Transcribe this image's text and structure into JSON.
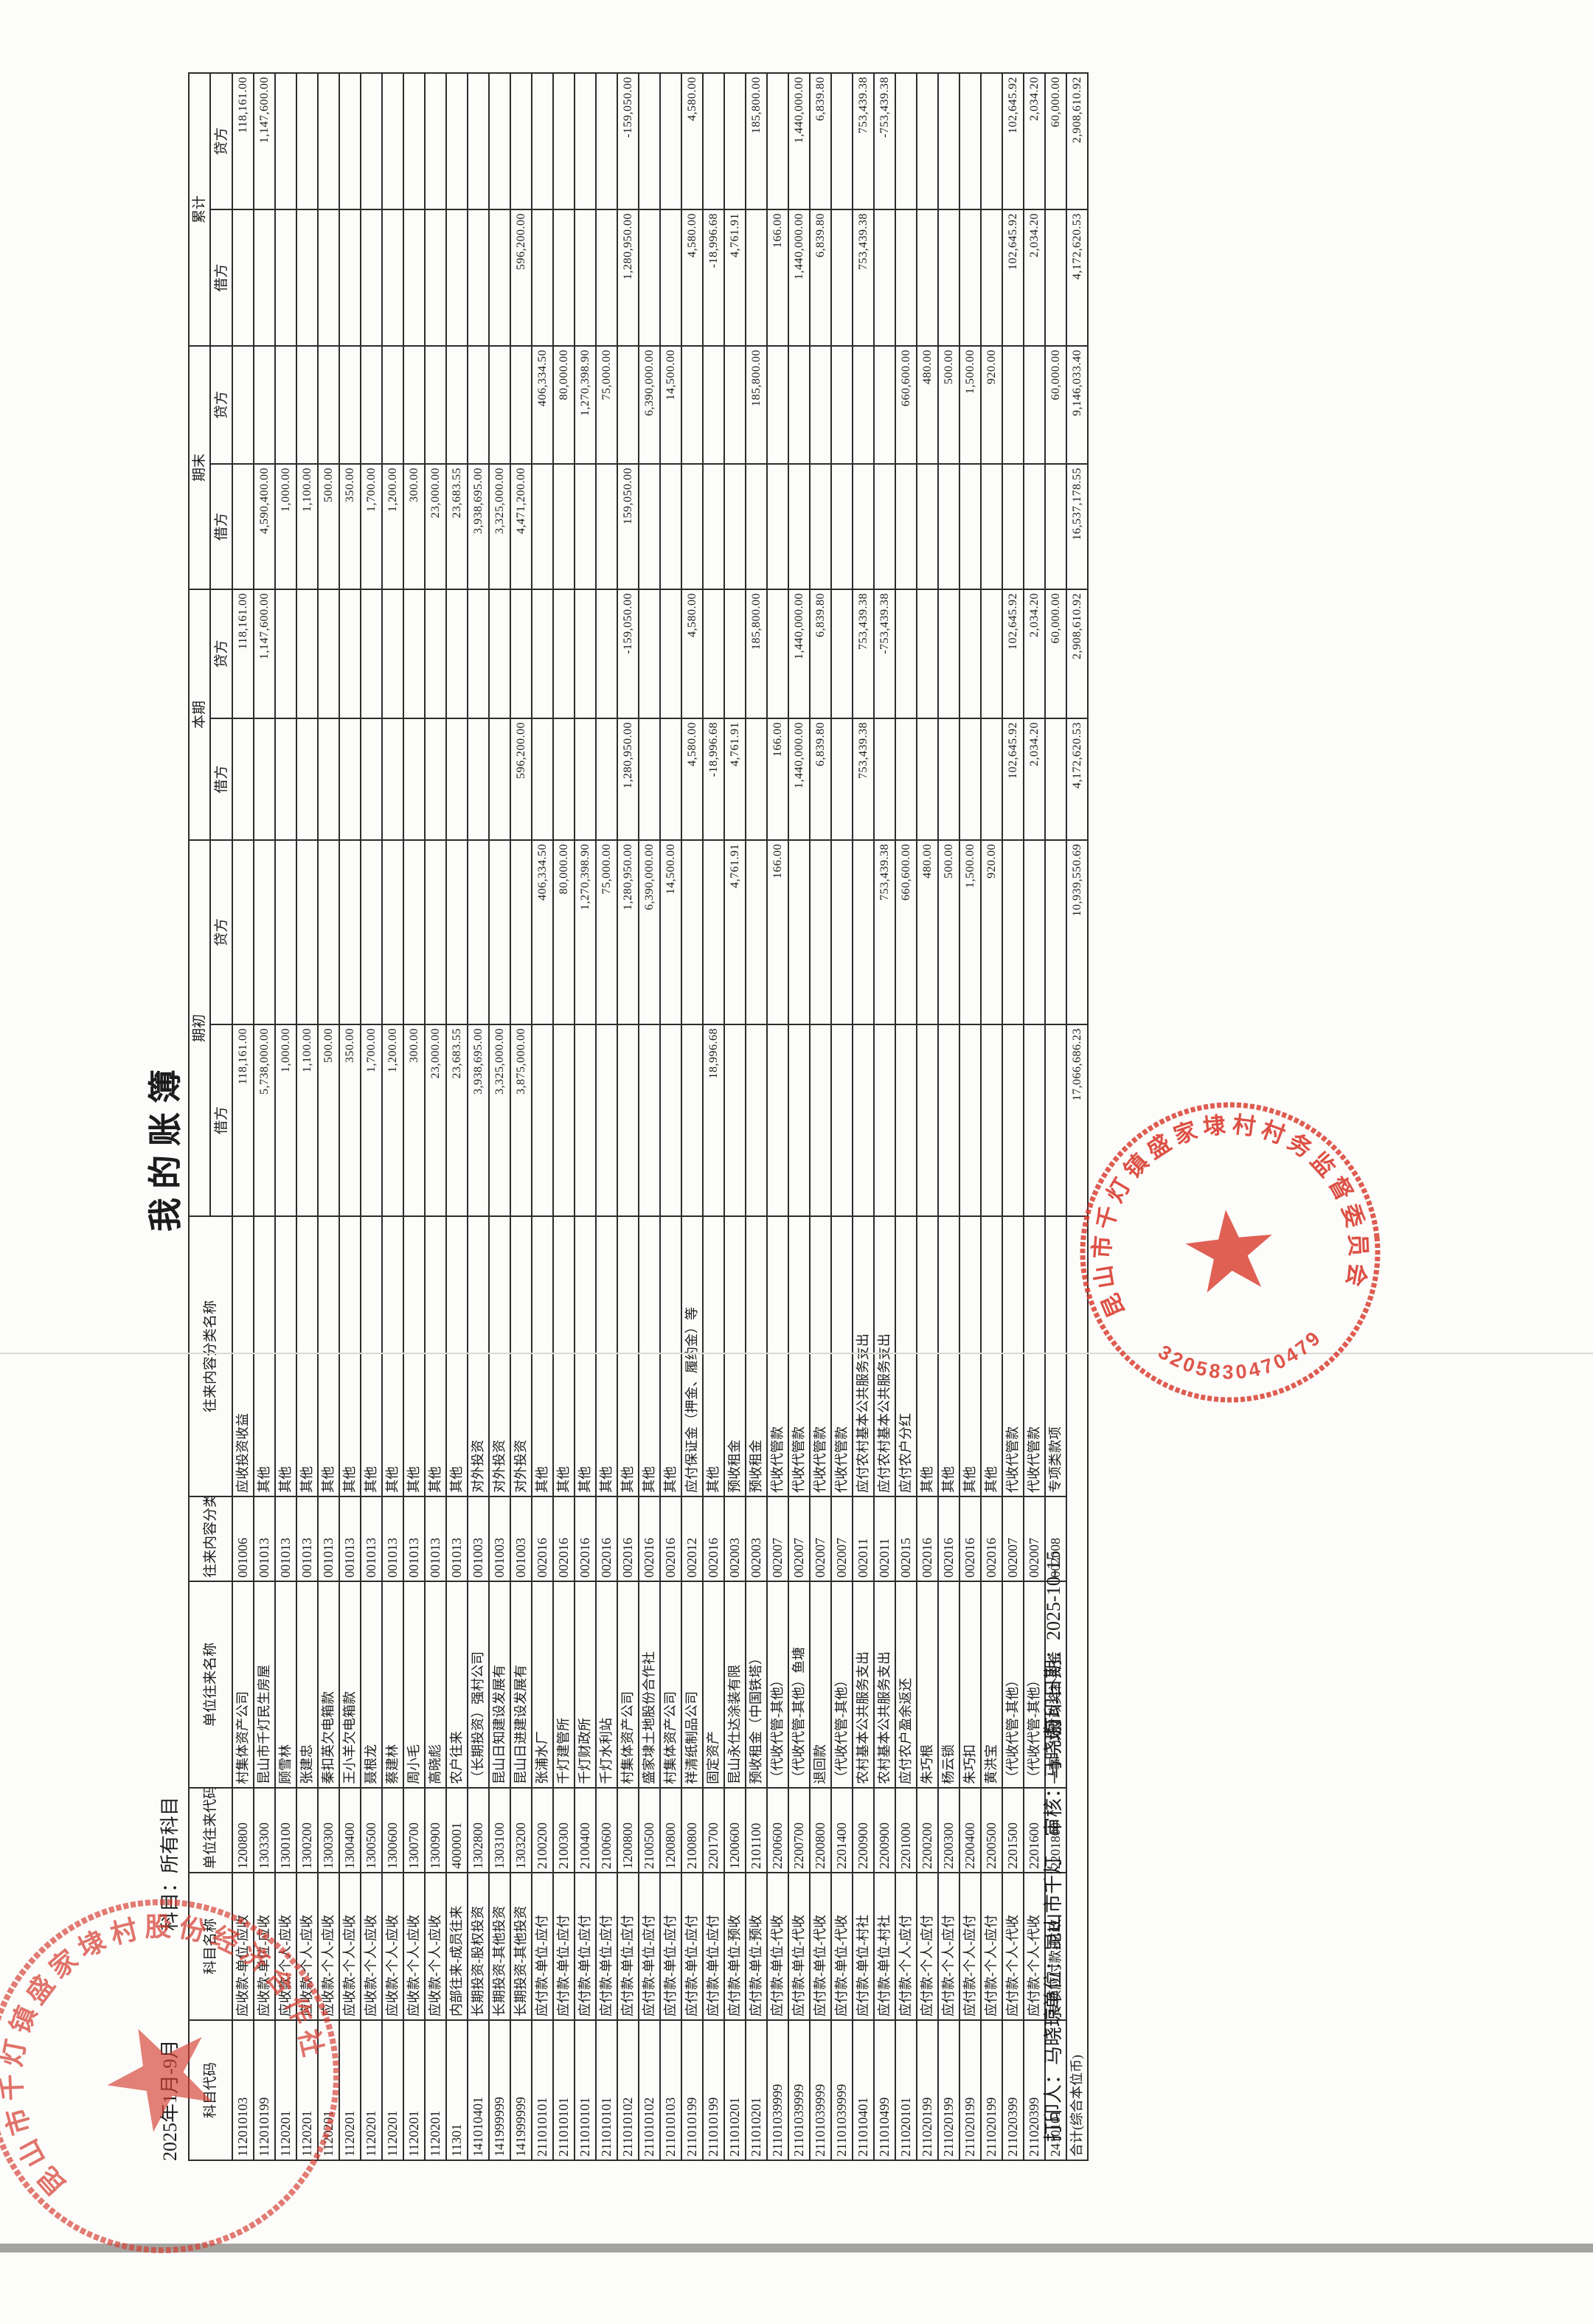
{
  "page": {
    "title": "我的账簿",
    "period": "2025年1月-9月",
    "subject_filter": "科目：所有科目",
    "footer": {
      "printer": "打印人：马晓琼",
      "unit_auditor": "单位：昆山市千灯　审核：马晓琼",
      "print_date": "打印日期：2025-10-15"
    }
  },
  "colors": {
    "stamp_red": "#d9382c",
    "border_black": "#2e2d2b",
    "paper": "#fcfcfa"
  },
  "table": {
    "header": {
      "text_columns": [
        "科目代码",
        "科目名称",
        "单位往来代码",
        "单位往来名称",
        "往来内容分类代码",
        "往来内容分类名称"
      ],
      "groups": [
        "期初",
        "本期",
        "期末",
        "累计"
      ],
      "debit_label": "借方",
      "credit_label": "贷方"
    },
    "rows": [
      [
        "112010103",
        "应收款-单位-应收",
        "1200800",
        "村集体资产公司",
        "001006",
        "应收投资收益",
        "118,161.00",
        "",
        "",
        "118,161.00",
        "",
        "",
        "",
        "118,161.00"
      ],
      [
        "112010199",
        "应收款-单位-应收",
        "1303300",
        "昆山市千灯民生房屋",
        "001013",
        "其他",
        "5,738,000.00",
        "",
        "",
        "1,147,600.00",
        "4,590,400.00",
        "",
        "",
        "1,147,600.00"
      ],
      [
        "1120201",
        "应收款-个人-应收",
        "1300100",
        "顾雪林",
        "001013",
        "其他",
        "1,000.00",
        "",
        "",
        "",
        "1,000.00",
        "",
        "",
        ""
      ],
      [
        "1120201",
        "应收款-个人-应收",
        "1300200",
        "张建忠",
        "001013",
        "其他",
        "1,100.00",
        "",
        "",
        "",
        "1,100.00",
        "",
        "",
        ""
      ],
      [
        "1120201",
        "应收款-个人-应收",
        "1300300",
        "秦扣英欠电箱款",
        "001013",
        "其他",
        "500.00",
        "",
        "",
        "",
        "500.00",
        "",
        "",
        ""
      ],
      [
        "1120201",
        "应收款-个人-应收",
        "1300400",
        "王小羊欠电箱款",
        "001013",
        "其他",
        "350.00",
        "",
        "",
        "",
        "350.00",
        "",
        "",
        ""
      ],
      [
        "1120201",
        "应收款-个人-应收",
        "1300500",
        "聂根龙",
        "001013",
        "其他",
        "1,700.00",
        "",
        "",
        "",
        "1,700.00",
        "",
        "",
        ""
      ],
      [
        "1120201",
        "应收款-个人-应收",
        "1300600",
        "蔡建林",
        "001013",
        "其他",
        "1,200.00",
        "",
        "",
        "",
        "1,200.00",
        "",
        "",
        ""
      ],
      [
        "1120201",
        "应收款-个人-应收",
        "1300700",
        "周小毛",
        "001013",
        "其他",
        "300.00",
        "",
        "",
        "",
        "300.00",
        "",
        "",
        ""
      ],
      [
        "1120201",
        "应收款-个人-应收",
        "1300900",
        "高晓彪",
        "001013",
        "其他",
        "23,000.00",
        "",
        "",
        "",
        "23,000.00",
        "",
        "",
        ""
      ],
      [
        "11301",
        "内部往来-成员往来",
        "4000001",
        "农户往来",
        "001013",
        "其他",
        "23,683.55",
        "",
        "",
        "",
        "23,683.55",
        "",
        "",
        ""
      ],
      [
        "141010401",
        "长期投资-股权投资",
        "1302800",
        "（长期投资）强村公司",
        "001003",
        "对外投资",
        "3,938,695.00",
        "",
        "",
        "",
        "3,938,695.00",
        "",
        "",
        ""
      ],
      [
        "141999999",
        "长期投资-其他投资",
        "1303100",
        "昆山日知建设发展有",
        "001003",
        "对外投资",
        "3,325,000.00",
        "",
        "",
        "",
        "3,325,000.00",
        "",
        "",
        ""
      ],
      [
        "141999999",
        "长期投资-其他投资",
        "1303200",
        "昆山日进建设发展有",
        "001003",
        "对外投资",
        "3,875,000.00",
        "",
        "596,200.00",
        "",
        "4,471,200.00",
        "",
        "596,200.00",
        ""
      ],
      [
        "211010101",
        "应付款-单位-应付",
        "2100200",
        "张浦水厂",
        "002016",
        "其他",
        "",
        "406,334.50",
        "",
        "",
        "",
        "406,334.50",
        "",
        ""
      ],
      [
        "211010101",
        "应付款-单位-应付",
        "2100300",
        "千灯建管所",
        "002016",
        "其他",
        "",
        "80,000.00",
        "",
        "",
        "",
        "80,000.00",
        "",
        ""
      ],
      [
        "211010101",
        "应付款-单位-应付",
        "2100400",
        "千灯财政所",
        "002016",
        "其他",
        "",
        "1,270,398.90",
        "",
        "",
        "",
        "1,270,398.90",
        "",
        ""
      ],
      [
        "211010101",
        "应付款-单位-应付",
        "2100600",
        "千灯水利站",
        "002016",
        "其他",
        "",
        "75,000.00",
        "",
        "",
        "",
        "75,000.00",
        "",
        ""
      ],
      [
        "211010102",
        "应付款-单位-应付",
        "1200800",
        "村集体资产公司",
        "002016",
        "其他",
        "",
        "1,280,950.00",
        "1,280,950.00",
        "-159,050.00",
        "159,050.00",
        "",
        "1,280,950.00",
        "-159,050.00"
      ],
      [
        "211010102",
        "应付款-单位-应付",
        "2100500",
        "盛家埭土地股份合作社",
        "002016",
        "其他",
        "",
        "6,390,000.00",
        "",
        "",
        "",
        "6,390,000.00",
        "",
        ""
      ],
      [
        "211010103",
        "应付款-单位-应付",
        "1200800",
        "村集体资产公司",
        "002016",
        "其他",
        "",
        "14,500.00",
        "",
        "",
        "",
        "14,500.00",
        "",
        ""
      ],
      [
        "211010199",
        "应付款-单位-应付",
        "2100800",
        "祥清纸制品公司",
        "002012",
        "应付保证金（押金、履约金）等",
        "",
        "",
        "4,580.00",
        "4,580.00",
        "",
        "",
        "4,580.00",
        "4,580.00"
      ],
      [
        "211010199",
        "应付款-单位-应付",
        "2201700",
        "固定资产",
        "002016",
        "其他",
        "18,996.68",
        "",
        "-18,996.68",
        "",
        "",
        "",
        "-18,996.68",
        ""
      ],
      [
        "211010201",
        "应付款-单位-预收",
        "1200600",
        "昆山永仕达涂装有限",
        "002003",
        "预收租金",
        "",
        "4,761.91",
        "4,761.91",
        "",
        "",
        "",
        "4,761.91",
        ""
      ],
      [
        "211010201",
        "应付款-单位-预收",
        "2101100",
        "预收租金（中国铁塔）",
        "002003",
        "预收租金",
        "",
        "",
        "",
        "185,800.00",
        "",
        "185,800.00",
        "",
        "185,800.00"
      ],
      [
        "21101039999",
        "应付款-单位-代收",
        "2200600",
        "（代收代管-其他）",
        "002007",
        "代收代管款",
        "",
        "166.00",
        "166.00",
        "",
        "",
        "",
        "166.00",
        ""
      ],
      [
        "21101039999",
        "应付款-单位-代收",
        "2200700",
        "（代收代管-其他）鱼塘",
        "002007",
        "代收代管款",
        "",
        "",
        "1,440,000.00",
        "1,440,000.00",
        "",
        "",
        "1,440,000.00",
        "1,440,000.00"
      ],
      [
        "21101039999",
        "应付款-单位-代收",
        "2200800",
        "退回款",
        "002007",
        "代收代管款",
        "",
        "",
        "6,839.80",
        "6,839.80",
        "",
        "",
        "6,839.80",
        "6,839.80"
      ],
      [
        "21101039999",
        "应付款-单位-代收",
        "2201400",
        "（代收代管-其他）",
        "002007",
        "代收代管款",
        "",
        "",
        "",
        "",
        "",
        "",
        "",
        ""
      ],
      [
        "211010401",
        "应付款-单位-村社",
        "2200900",
        "农村基本公共服务支出",
        "002011",
        "应付农村基本公共服务支出",
        "",
        "",
        "753,439.38",
        "753,439.38",
        "",
        "",
        "753,439.38",
        "753,439.38"
      ],
      [
        "211010499",
        "应付款-单位-村社",
        "2200900",
        "农村基本公共服务支出",
        "002011",
        "应付农村基本公共服务支出",
        "",
        "753,439.38",
        "",
        "-753,439.38",
        "",
        "",
        "",
        "-753,439.38"
      ],
      [
        "211020101",
        "应付款-个人-应付",
        "2201000",
        "应付农户盈余返还",
        "002015",
        "应付农户分红",
        "",
        "660,600.00",
        "",
        "",
        "",
        "660,600.00",
        "",
        ""
      ],
      [
        "211020199",
        "应付款-个人-应付",
        "2200200",
        "朱巧根",
        "002016",
        "其他",
        "",
        "480.00",
        "",
        "",
        "",
        "480.00",
        "",
        ""
      ],
      [
        "211020199",
        "应付款-个人-应付",
        "2200300",
        "杨云锁",
        "002016",
        "其他",
        "",
        "500.00",
        "",
        "",
        "",
        "500.00",
        "",
        ""
      ],
      [
        "211020199",
        "应付款-个人-应付",
        "2200400",
        "朱巧扣",
        "002016",
        "其他",
        "",
        "1,500.00",
        "",
        "",
        "",
        "1,500.00",
        "",
        ""
      ],
      [
        "211020199",
        "应付款-个人-应付",
        "2200500",
        "黄洪宝",
        "002016",
        "其他",
        "",
        "920.00",
        "",
        "",
        "",
        "920.00",
        "",
        ""
      ],
      [
        "211020399",
        "应付款-个人-代收",
        "2201500",
        "（代收代管-其他）",
        "002007",
        "代收代管款",
        "",
        "",
        "102,645.92",
        "102,645.92",
        "",
        "",
        "102,645.92",
        "102,645.92"
      ],
      [
        "211020399",
        "应付款-个人-代收",
        "2201600",
        "（代收代管-其他）",
        "002007",
        "代收代管款",
        "",
        "",
        "2,034.20",
        "2,034.20",
        "",
        "",
        "2,034.20",
        "2,034.20"
      ],
      [
        "2410101",
        "专项应付款-财政",
        "2201800",
        "一事一议财政奖补资金",
        "002008",
        "专项类款项",
        "",
        "",
        "",
        "60,000.00",
        "",
        "60,000.00",
        "",
        "60,000.00"
      ]
    ],
    "total_row": {
      "label": "合计(综合本位币)",
      "values": [
        "17,066,686.23",
        "10,939,550.69",
        "4,172,620.53",
        "2,908,610.92",
        "16,537,178.55",
        "9,146,033.40",
        "4,172,620.53",
        "2,908,610.92"
      ]
    }
  },
  "stamps": {
    "supervision_seal": {
      "arc_text": "昆山市千灯镇盛家埭村村务监督委员会",
      "number": "3205830470479"
    },
    "cooperative_seal": {
      "arc_text": "昆山市千灯镇盛家埭村股份经济合作社"
    }
  }
}
